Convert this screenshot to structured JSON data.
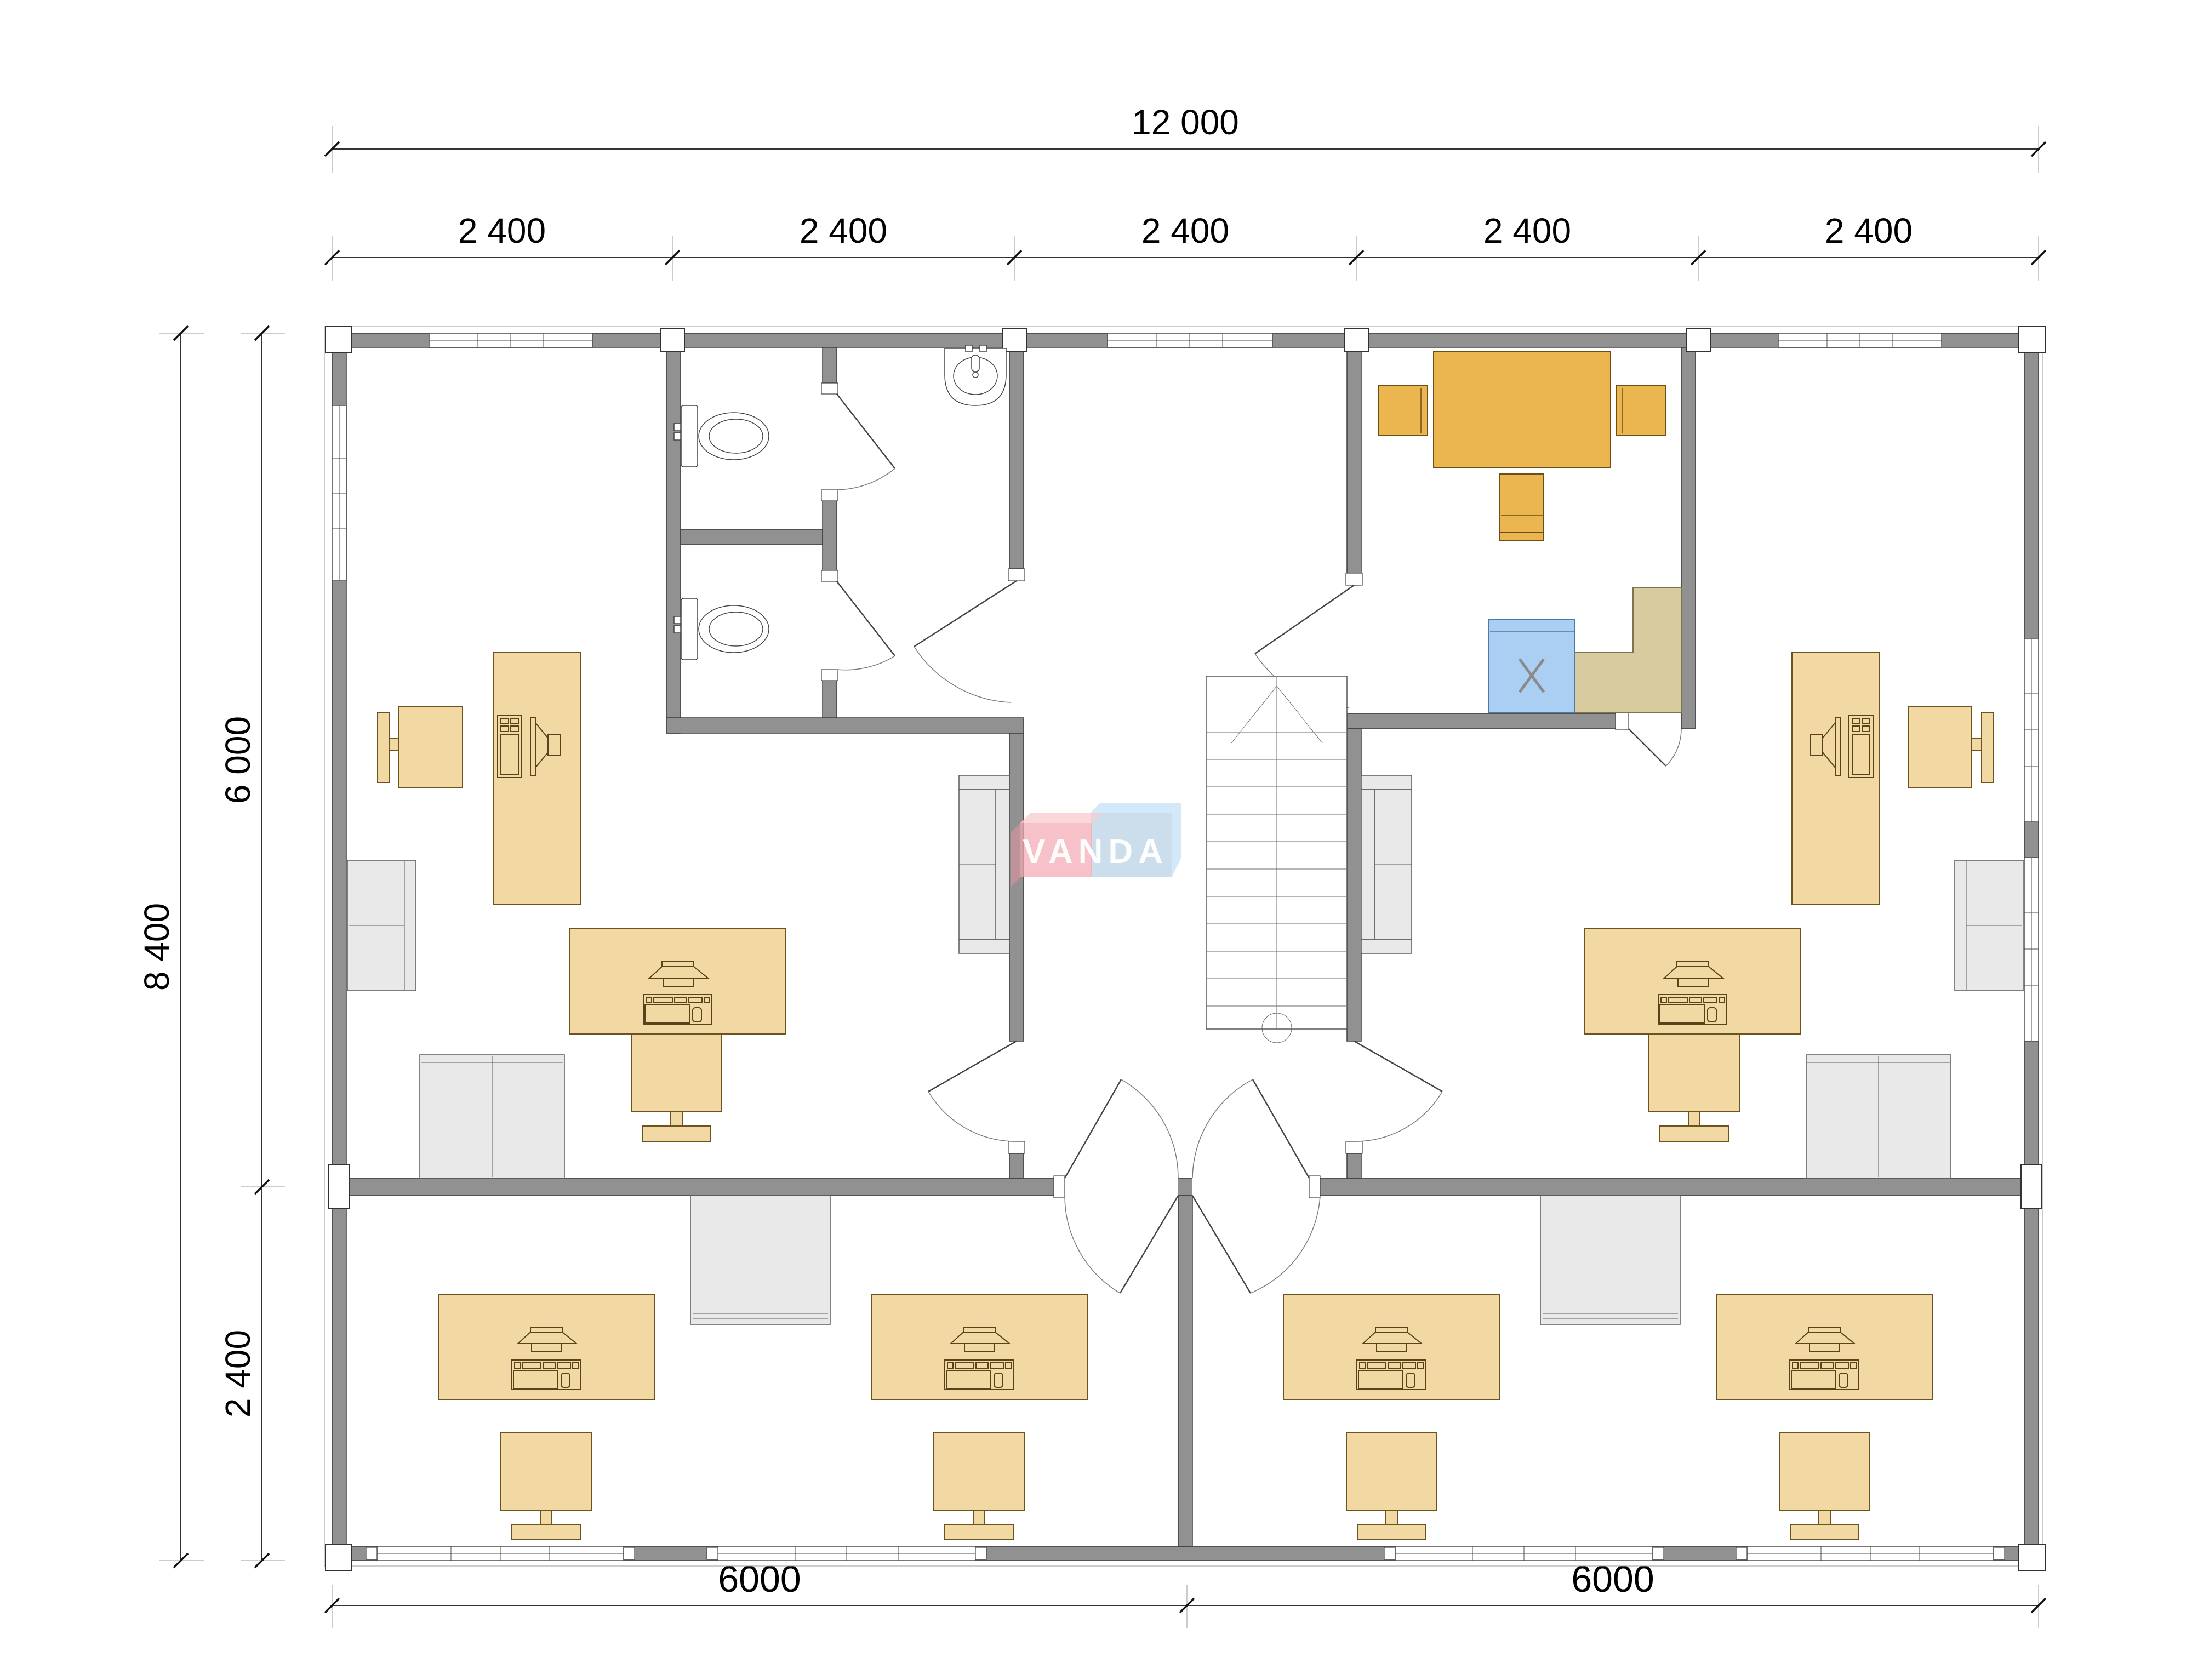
{
  "dimensions": {
    "total_width": "12 000",
    "bays": [
      "2 400",
      "2 400",
      "2 400",
      "2 400",
      "2 400"
    ],
    "total_height": "8 400",
    "upper_height": "6 000",
    "lower_height": "2 400",
    "bottom_spans": [
      "6000",
      "6000"
    ]
  },
  "brand": {
    "logo_text": "VANDA"
  },
  "kitchen": {
    "appliance_mark": "X"
  },
  "colors": {
    "wall": "#919191",
    "desk": "#f2d8a2",
    "meeting_table": "#ebb54f",
    "counter": "#d8cba0",
    "appliance": "#abcff2",
    "furniture_gray": "#e9e9e9",
    "logo_pink": "#f2a9b4",
    "logo_blue": "#b6d6ee"
  },
  "icons": {
    "stairs_direction": "chevron-up-arrow",
    "appliance_marker": "x-cross",
    "workstation": "desk-with-pc-top-view"
  }
}
